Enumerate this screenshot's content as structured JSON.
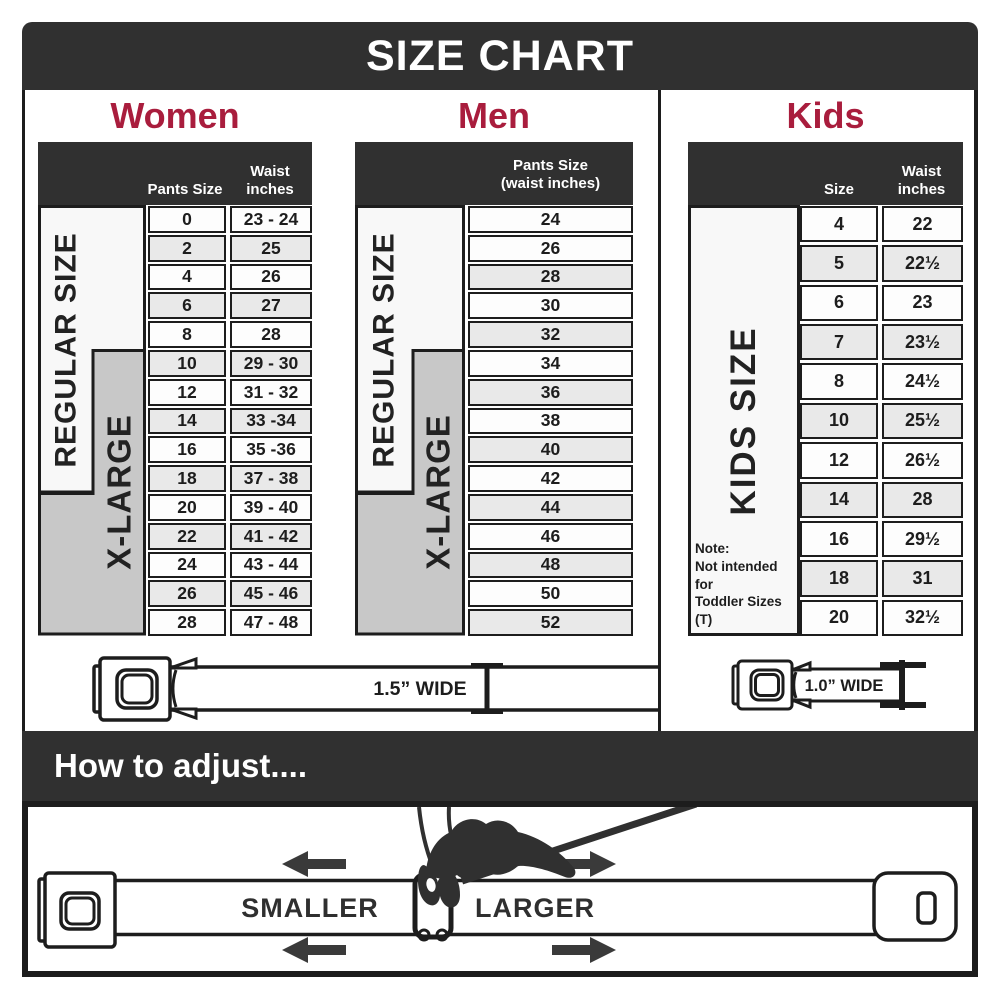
{
  "title": "SIZE CHART",
  "colors": {
    "banner": "#303030",
    "accent": "#a91d3d",
    "line": "#1d1d1d",
    "row": "#fdfdfd",
    "rowalt": "#e9e9e9",
    "box": "#f8f8f8",
    "graybox": "#c8c8c8",
    "arrow": "#3a3a3a"
  },
  "sections": {
    "women": {
      "heading": "Women",
      "col1_header": "Pants Size",
      "col2_header": "Waist\ninches",
      "regular_label": "REGULAR SIZE",
      "xlarge_label": "X-LARGE",
      "rows": [
        [
          "0",
          "23 - 24"
        ],
        [
          "2",
          "25"
        ],
        [
          "4",
          "26"
        ],
        [
          "6",
          "27"
        ],
        [
          "8",
          "28"
        ],
        [
          "10",
          "29 - 30"
        ],
        [
          "12",
          "31 - 32"
        ],
        [
          "14",
          "33 -34"
        ],
        [
          "16",
          "35 -36"
        ],
        [
          "18",
          "37 - 38"
        ],
        [
          "20",
          "39 - 40"
        ],
        [
          "22",
          "41 - 42"
        ],
        [
          "24",
          "43 - 44"
        ],
        [
          "26",
          "45 - 46"
        ],
        [
          "28",
          "47 - 48"
        ]
      ]
    },
    "men": {
      "heading": "Men",
      "col_header": "Pants Size\n(waist inches)",
      "regular_label": "REGULAR SIZE",
      "xlarge_label": "X-LARGE",
      "rows": [
        "24",
        "26",
        "28",
        "30",
        "32",
        "34",
        "36",
        "38",
        "40",
        "42",
        "44",
        "46",
        "48",
        "50",
        "52"
      ]
    },
    "kids": {
      "heading": "Kids",
      "col1_header": "Size",
      "col2_header": "Waist\ninches",
      "side_label": "KIDS SIZE",
      "note": "Note:\nNot intended for\nToddler Sizes (T)",
      "rows": [
        [
          "4",
          "22"
        ],
        [
          "5",
          "22½"
        ],
        [
          "6",
          "23"
        ],
        [
          "7",
          "23½"
        ],
        [
          "8",
          "24½"
        ],
        [
          "10",
          "25½"
        ],
        [
          "12",
          "26½"
        ],
        [
          "14",
          "28"
        ],
        [
          "16",
          "29½"
        ],
        [
          "18",
          "31"
        ],
        [
          "20",
          "32½"
        ]
      ]
    }
  },
  "belts": {
    "adult_width_label": "1.5” WIDE",
    "kids_width_label": "1.0” WIDE"
  },
  "how_to_adjust": {
    "heading": "How to adjust....",
    "smaller_label": "SMALLER",
    "larger_label": "LARGER"
  }
}
